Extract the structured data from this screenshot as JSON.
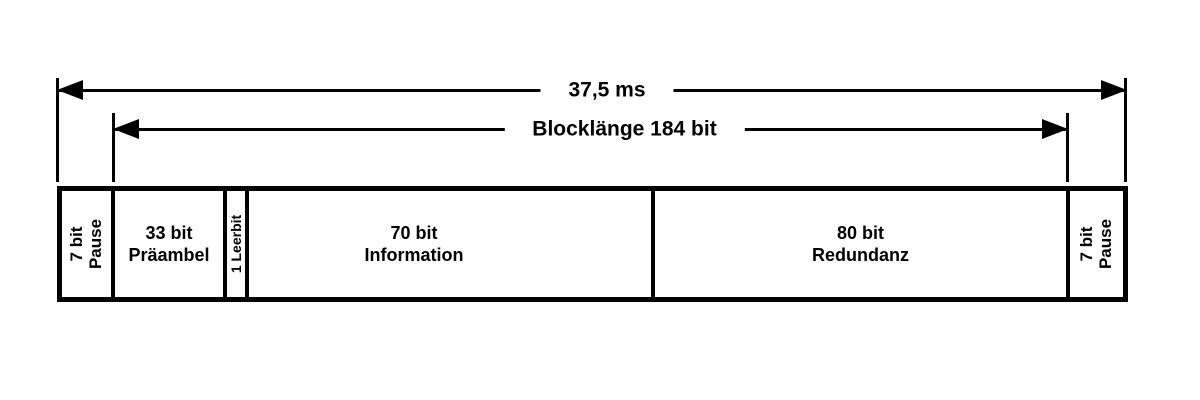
{
  "page": {
    "background_color": "#ffffff",
    "line_color": "#000000"
  },
  "dimension_arrows": {
    "total": {
      "label": "37,5 ms"
    },
    "block": {
      "label": "Blocklänge 184 bit"
    }
  },
  "bar": {
    "segments": [
      {
        "line1": "7 bit",
        "line2": "Pause",
        "orientation": "vertical"
      },
      {
        "line1": "33 bit",
        "line2": "Präambel",
        "orientation": "horizontal"
      },
      {
        "line1": "1 Leerbit",
        "orientation": "vertical"
      },
      {
        "line1": "70 bit",
        "line2": "Information",
        "orientation": "horizontal"
      },
      {
        "line1": "80 bit",
        "line2": "Redundanz",
        "orientation": "horizontal"
      },
      {
        "line1": "7 bit",
        "line2": "Pause",
        "orientation": "vertical"
      }
    ]
  }
}
